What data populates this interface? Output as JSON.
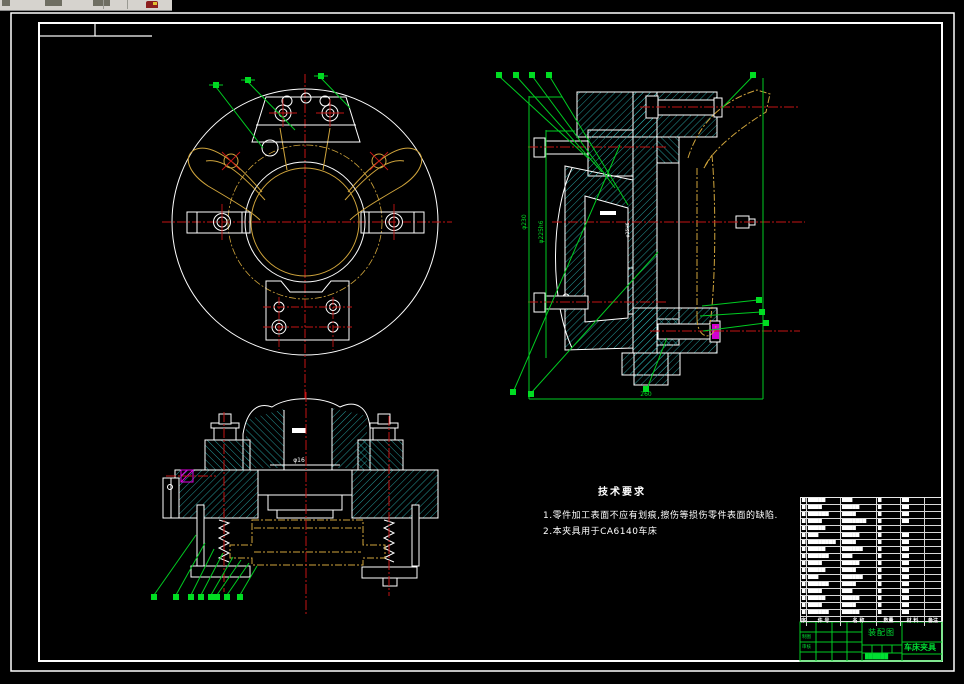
{
  "app": {
    "toolbar_note": "partial windows toolbar remnant"
  },
  "colors": {
    "outline": "#ffffff",
    "hatch": "#2fbfbf",
    "centerline": "#c41414",
    "phantom_part": "#cfa43c",
    "annotation_green": "#00cc22",
    "highlight_magenta": "#ff00ff",
    "sheet_background": "#000000",
    "toolbar_background": "#d6d3ce"
  },
  "dimensions": {
    "outer_dia": "φ230",
    "fit_dia": "φ225h6",
    "overall_width": "260",
    "bore_dia": "φ16",
    "pilot_dia": "φ25H6"
  },
  "tech_requirements": {
    "title": "技术要求",
    "items": [
      "1.零件加工表面不应有划痕,擦伤等损伤零件表面的缺陷.",
      "2.本夹具用于CA6140车床"
    ]
  },
  "parts_list": {
    "headers": [
      "序",
      "件 号",
      "名 称",
      "数量",
      "材 料",
      "备注"
    ],
    "rows": [
      [
        "█",
        "█████",
        "███",
        "█",
        "██",
        ""
      ],
      [
        "█",
        "████",
        "█████",
        "█",
        "██",
        ""
      ],
      [
        "█",
        "██████",
        "████",
        "█",
        "██",
        ""
      ],
      [
        "█",
        "████",
        "███████",
        "█",
        "██",
        ""
      ],
      [
        "█",
        "█████",
        "████",
        "█",
        "",
        ""
      ],
      [
        "█",
        "███",
        "█████",
        "█",
        "██",
        ""
      ],
      [
        "█",
        "████████",
        "████",
        "█",
        "██",
        ""
      ],
      [
        "█",
        "█████",
        "██████",
        "█",
        "██",
        ""
      ],
      [
        "█",
        "██████",
        "███",
        "█",
        "██",
        ""
      ],
      [
        "█",
        "████",
        "█████",
        "█",
        "██",
        ""
      ],
      [
        "█",
        "█████",
        "████",
        "█",
        "██",
        ""
      ],
      [
        "█",
        "███",
        "██████",
        "█",
        "██",
        ""
      ],
      [
        "█",
        "██████",
        "████",
        "█",
        "██",
        ""
      ],
      [
        "█",
        "████",
        "███",
        "█",
        "██",
        ""
      ],
      [
        "█",
        "█████",
        "█████",
        "█",
        "██",
        ""
      ],
      [
        "█",
        "████",
        "████",
        "█",
        "██",
        ""
      ],
      [
        "█",
        "██████",
        "█████",
        "█",
        "██",
        ""
      ]
    ]
  },
  "title_block": {
    "drawing_name": "装配图",
    "project_name": "车床夹具",
    "left_labels": [
      "制图",
      "审核"
    ],
    "doc_number": "██████"
  }
}
